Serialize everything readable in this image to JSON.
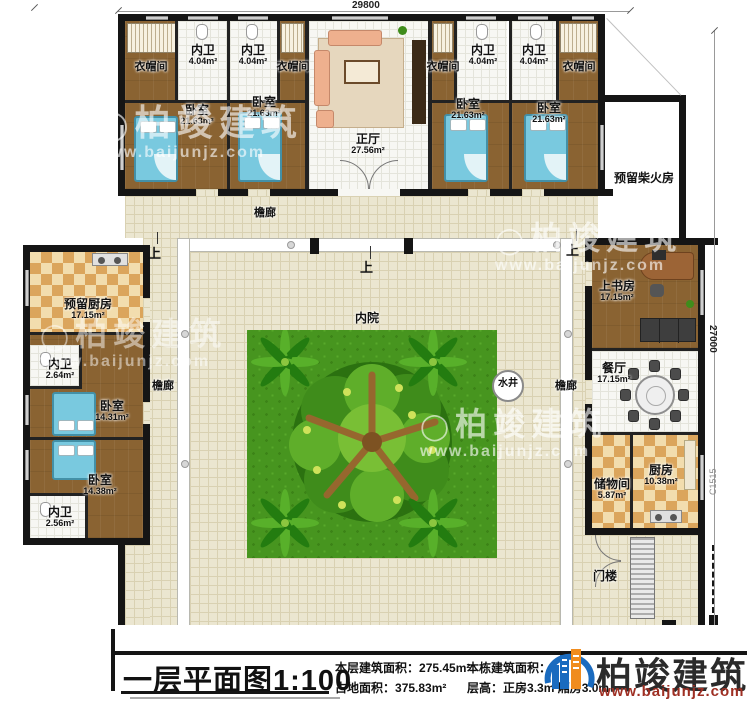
{
  "title_block": {
    "title": "一层平面图1:100",
    "stats": [
      {
        "label": "本层建筑面积：",
        "value": "275.45m²"
      },
      {
        "label": "占地面积：",
        "value": "375.83m²"
      },
      {
        "label": "本栋建筑面积：",
        "value": ""
      },
      {
        "label": "层高：",
        "value": "正房3.3m 厢房3.0m"
      }
    ]
  },
  "brand": {
    "name": "柏竣建筑",
    "url": "www.baijunjz.com"
  },
  "watermark": {
    "name": "柏竣建筑",
    "url": "www.baijunjz.com"
  },
  "dimensions": {
    "top": "29800",
    "right": "27000",
    "window_code": "C1515"
  },
  "rooms": {
    "cloakroom": {
      "name": "衣帽间"
    },
    "inner_toilet_top": {
      "name": "内卫",
      "area": "4.04m²"
    },
    "bedroom_top": {
      "name": "卧室",
      "area": "21.63m²"
    },
    "main_hall": {
      "name": "正厅",
      "area": "27.56m²"
    },
    "firewood_room": {
      "name": "预留柴火房"
    },
    "reserved_kitchen": {
      "name": "预留厨房",
      "area": "17.15m²"
    },
    "toilet_264": {
      "name": "内卫",
      "area": "2.64m²"
    },
    "bedroom_1431": {
      "name": "卧室",
      "area": "14.31m²"
    },
    "bedroom_1438": {
      "name": "卧室",
      "area": "14.38m²"
    },
    "toilet_256": {
      "name": "内卫",
      "area": "2.56m²"
    },
    "study": {
      "name": "上书房",
      "area": "17.15m²"
    },
    "dining": {
      "name": "餐厅",
      "area": "17.15m²"
    },
    "storage": {
      "name": "储物间",
      "area": "5.87m²"
    },
    "kitchen": {
      "name": "厨房",
      "area": "10.38m²"
    },
    "veranda": {
      "name": "檐廊"
    },
    "inner_court": {
      "name": "内院"
    },
    "well": {
      "name": "水井"
    },
    "gatehouse": {
      "name": "门楼"
    },
    "stair_up": {
      "name": "上"
    }
  }
}
